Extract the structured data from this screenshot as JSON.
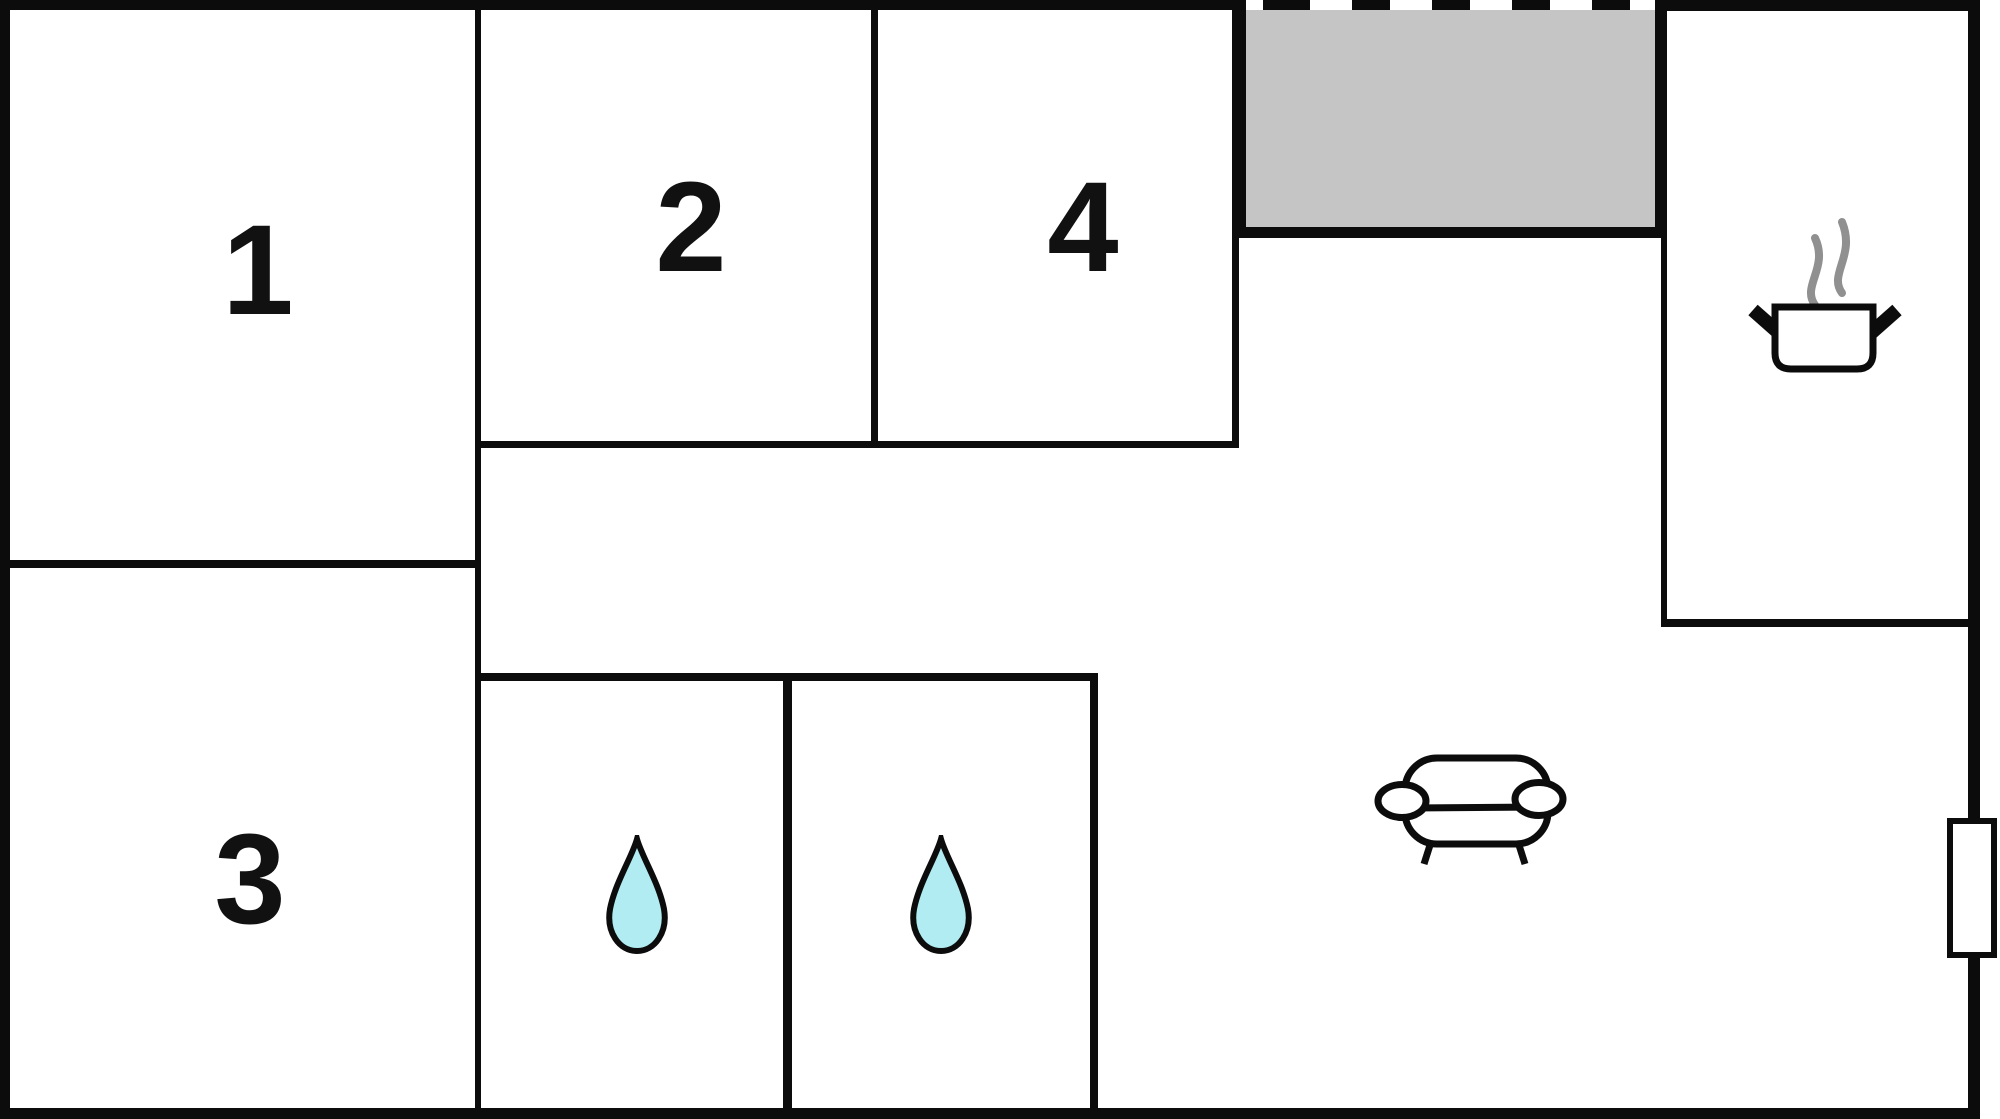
{
  "title": "apartment-floor-plan",
  "colors": {
    "wall": "#0c0c0c",
    "background": "#ffffff",
    "terrace_fill": "#c5c5c5",
    "water_drop_fill": "#b0ecf1",
    "steam": "#909090",
    "label": "#111111"
  },
  "rooms": [
    {
      "id": "room-1",
      "label": "1"
    },
    {
      "id": "room-2",
      "label": "2"
    },
    {
      "id": "room-3",
      "label": "3"
    },
    {
      "id": "room-4",
      "label": "4"
    }
  ],
  "icons": {
    "bath_left": "water-drop-icon",
    "bath_right": "water-drop-icon",
    "kitchen": "cooking-pot-steam-icon",
    "living": "sofa-icon",
    "right_wall": "window-door-marker",
    "terrace_edge": "dashed-open-edge"
  }
}
